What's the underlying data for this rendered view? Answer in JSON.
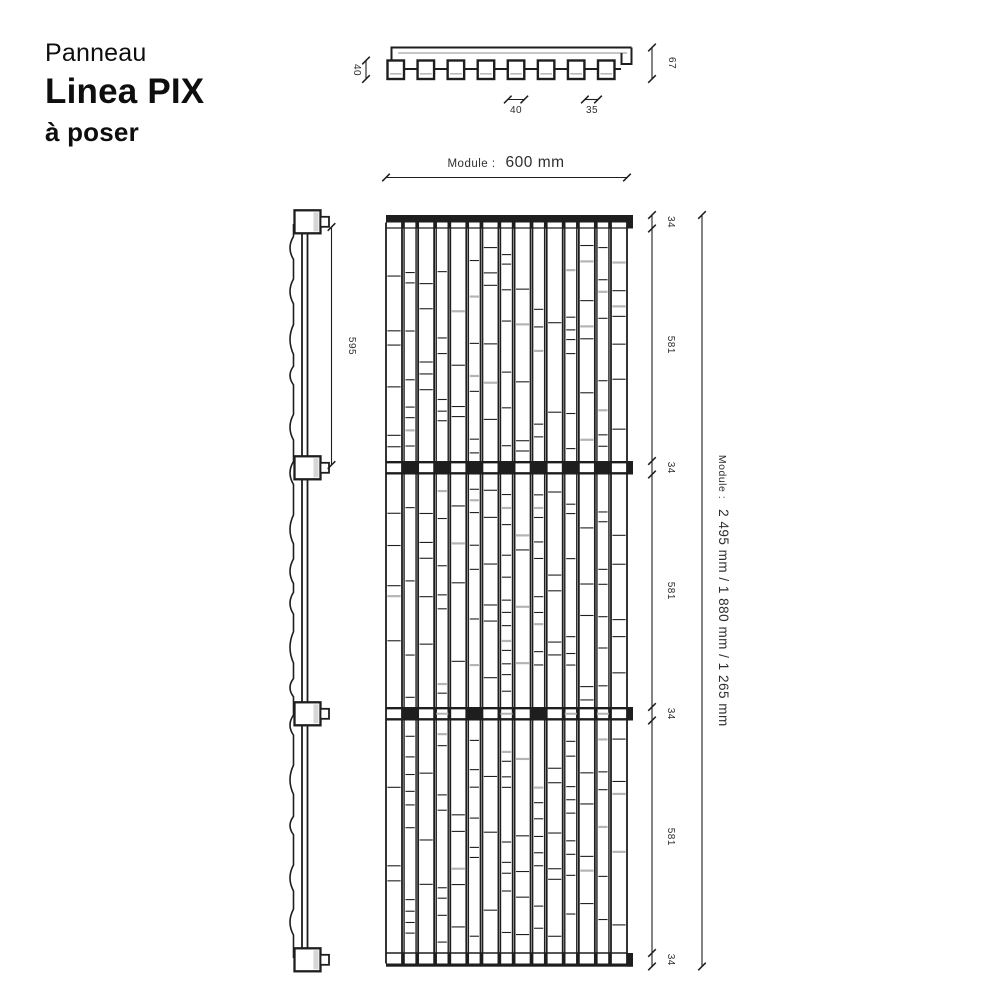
{
  "title": {
    "category": "Panneau",
    "name": "Linea PIX",
    "variant": "à poser"
  },
  "top_view": {
    "slat_depth_dim": "40",
    "panel_depth_dim": "67",
    "slat_width_dim": "40",
    "gap_width_dim": "35"
  },
  "width_dim": {
    "prefix": "Module :",
    "value": "600 mm"
  },
  "side_view": {
    "spacing_dim": "595"
  },
  "front_view": {
    "vertical_dims": [
      "34",
      "581",
      "34",
      "581",
      "34",
      "581",
      "34"
    ]
  },
  "height_dim": {
    "prefix": "Module :",
    "value": "2 495 mm / 1 880 mm / 1 265 mm"
  },
  "style": {
    "background": "#ffffff",
    "ink": "#1e1e1e",
    "text": "#2e2e2e",
    "gray_line": "#b4b4b4",
    "light_gray": "#d6d6d6",
    "pattern_seed": 11
  }
}
